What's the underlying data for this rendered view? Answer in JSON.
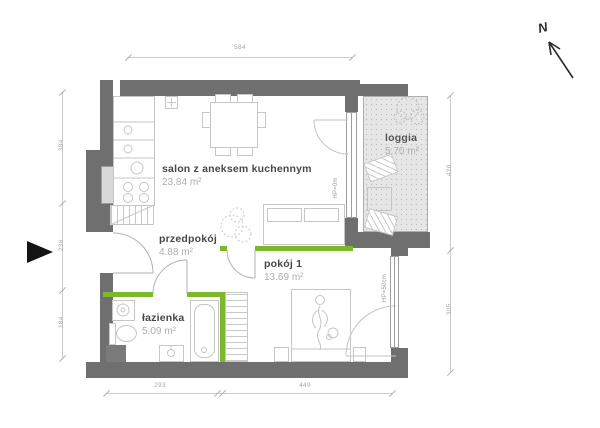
{
  "rooms": [
    {
      "id": "salon",
      "name": "salon z aneksem kuchennym",
      "area": "23.84",
      "unit": "m²"
    },
    {
      "id": "przedpokoj",
      "name": "przedpokój",
      "area": "4.88",
      "unit": "m²"
    },
    {
      "id": "pokoj1",
      "name": "pokój 1",
      "area": "13.69",
      "unit": "m²"
    },
    {
      "id": "lazienka",
      "name": "łazienka",
      "area": "5.09",
      "unit": "m²"
    },
    {
      "id": "loggia",
      "name": "loggia",
      "area": "5.70",
      "unit": "m²"
    }
  ],
  "window_labels": {
    "loggia_door": "HP=0m",
    "bedroom_window": "HP=50cm"
  },
  "dimensions": {
    "top": {
      "total": "584"
    },
    "left": {
      "segments": [
        "304",
        "236",
        "184"
      ]
    },
    "right": {
      "segments": [
        "420",
        "305"
      ]
    },
    "bottom": {
      "segments": [
        "293",
        "449"
      ]
    }
  },
  "compass": {
    "label": "N"
  },
  "colors": {
    "wall": "#6f6f6f",
    "accent_green": "#7cb82a",
    "loggia_fill": "#e6e6e6",
    "dimension_line": "#cccccc",
    "room_name": "#474747",
    "room_area": "#aeaeae"
  }
}
